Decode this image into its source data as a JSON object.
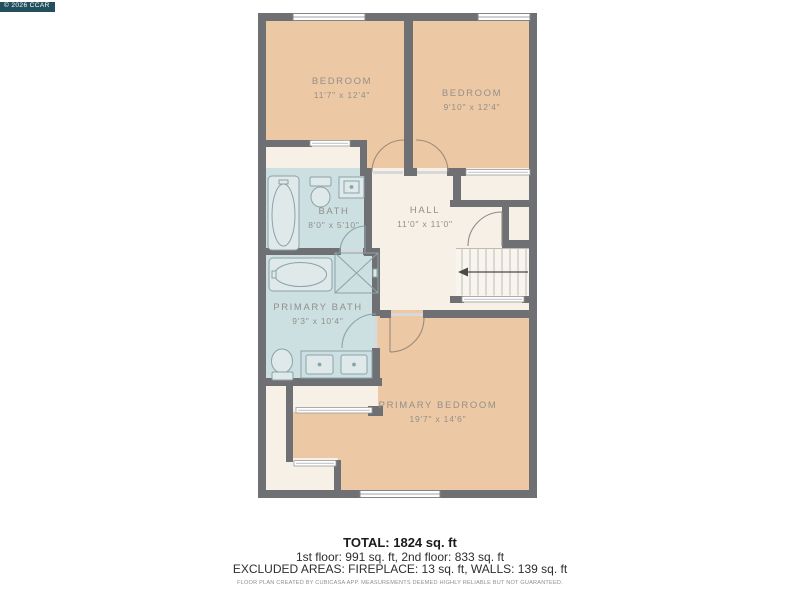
{
  "copyright": "© 2026 CCAR",
  "plan": {
    "floor": "2nd floor",
    "rooms": {
      "bedroom_1": {
        "name": "BEDROOM",
        "dims": "11'7\" x 12'4\""
      },
      "bedroom_2": {
        "name": "BEDROOM",
        "dims": "9'10\" x 12'4\""
      },
      "bath": {
        "name": "BATH",
        "dims": "8'0\" x 5'10\""
      },
      "hall": {
        "name": "HALL",
        "dims": "11'0\" x 11'0\""
      },
      "primary_bath": {
        "name": "PRIMARY BATH",
        "dims": "9'3\" x 10'4\""
      },
      "primary_bedroom": {
        "name": "PRIMARY BEDROOM",
        "dims": "19'7\" x 14'6\""
      }
    },
    "colors": {
      "wall": "#6F7073",
      "bedroom_fill": "#EDC8A4",
      "bath_fill": "#CCDFE1",
      "hall_fill": "#F6F0E6",
      "stair_fill": "#F8F4EE",
      "label_text": "#93908A",
      "copyright_bg": "#23505F"
    }
  },
  "footer": {
    "total": "TOTAL: 1824 sq. ft",
    "floors": "1st floor: 991 sq. ft, 2nd floor: 833 sq. ft",
    "excluded": "EXCLUDED AREAS: FIREPLACE: 13 sq. ft, WALLS: 139 sq. ft",
    "disclaimer": "FLOOR PLAN CREATED BY CUBICASA APP. MEASUREMENTS DEEMED HIGHLY RELIABLE BUT NOT GUARANTEED."
  }
}
